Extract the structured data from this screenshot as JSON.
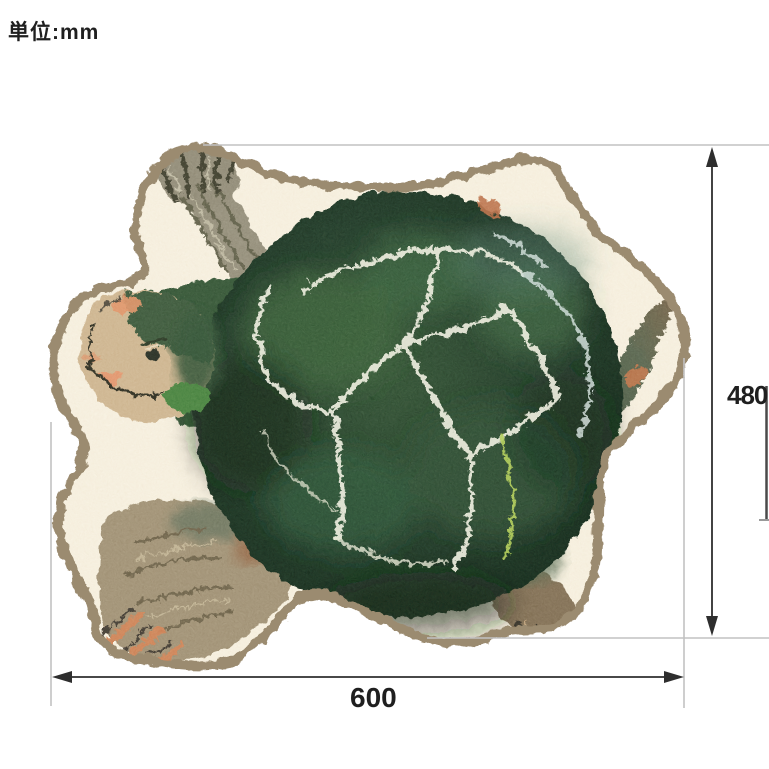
{
  "annotation": {
    "unit_label": "単位:mm",
    "height_value": "480",
    "width_value": "600"
  },
  "colors": {
    "background": "#ffffff",
    "label_text": "#1f1f1f",
    "dimension_line": "#2e2e2e",
    "extension_line": "#c2c2c2",
    "edge_artifact": "#4a4a4a",
    "rug_base": "#f2e9d5",
    "rug_border": "#9b8b6f",
    "shell_dark": "#15271b",
    "shell_mid": "#2b4d2e",
    "shell_light": "#477242",
    "crack_line": "#e9ead8",
    "crack_blue": "#c6d6d0",
    "crack_chartreuse": "#a9c84c",
    "head_skin": "#c8ad86",
    "head_patch_green": "#2b4a2d",
    "cheek_spot": "#3c7836",
    "accent_orange": "#dd8a5c",
    "claw_orange": "#c8794e",
    "front_leg": "#8a8470",
    "front_foot": "#87816d",
    "rear_leg_brown": "#77644a",
    "flipper_tan": "#97876a"
  }
}
